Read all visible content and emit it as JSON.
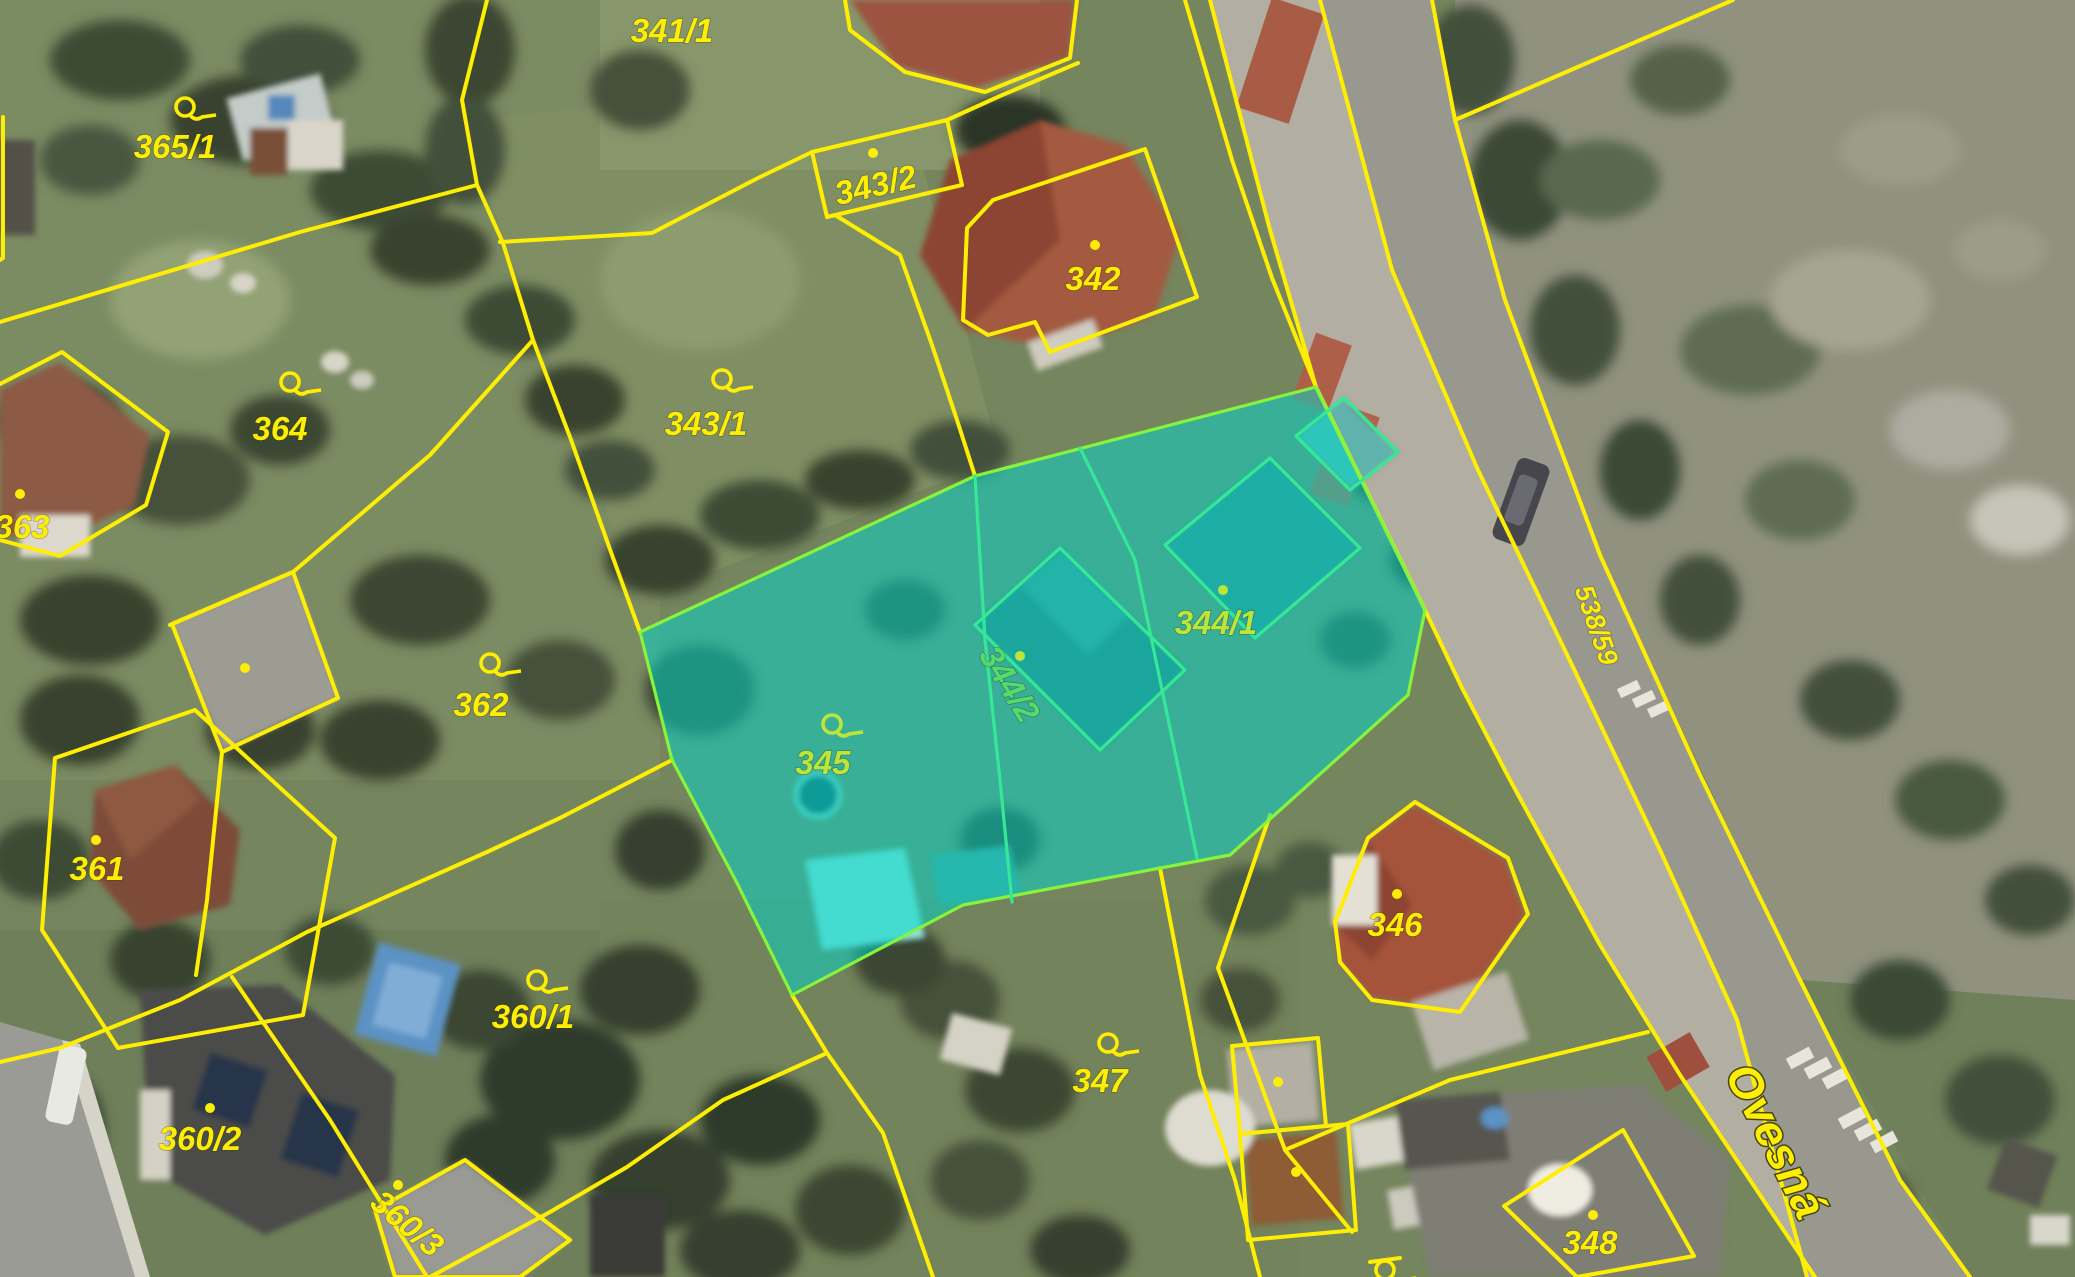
{
  "app": {
    "title": "Cadastral map with orthophoto"
  },
  "map": {
    "colors": {
      "boundary": "#FFEE00",
      "label": "#FFEE00",
      "highlight_fill": "rgba(0,214,202,0.52)",
      "highlight_border": "#86F43C",
      "inner_line": "#35E896",
      "highlight_label": "#BCE53C",
      "highlight_label_alt": "#55DA6C"
    },
    "street": {
      "name": "Ovesná"
    },
    "road_parcel": {
      "label": "538/59"
    },
    "selection": {
      "highlighted_parcels": [
        "344/1",
        "344/2",
        "345"
      ]
    },
    "parcels": [
      {
        "label": "365/1",
        "marker": "pin"
      },
      {
        "label": "341/1",
        "marker": "none"
      },
      {
        "label": "343/2",
        "marker": "dot"
      },
      {
        "label": "342",
        "marker": "dot"
      },
      {
        "label": "364",
        "marker": "pin"
      },
      {
        "label": "343/1",
        "marker": "pin"
      },
      {
        "label": "363",
        "marker": "dot"
      },
      {
        "label": "362",
        "marker": "pin"
      },
      {
        "label": "344/1",
        "marker": "dot",
        "highlighted": true
      },
      {
        "label": "344/2",
        "marker": "dot",
        "highlighted": true
      },
      {
        "label": "345",
        "marker": "pin",
        "highlighted": true
      },
      {
        "label": "361",
        "marker": "dot"
      },
      {
        "label": "360/1",
        "marker": "pin"
      },
      {
        "label": "346",
        "marker": "dot"
      },
      {
        "label": "347",
        "marker": "pin"
      },
      {
        "label": "360/2",
        "marker": "dot"
      },
      {
        "label": "360/3",
        "marker": "dot"
      },
      {
        "label": "348",
        "marker": "dot"
      }
    ]
  }
}
